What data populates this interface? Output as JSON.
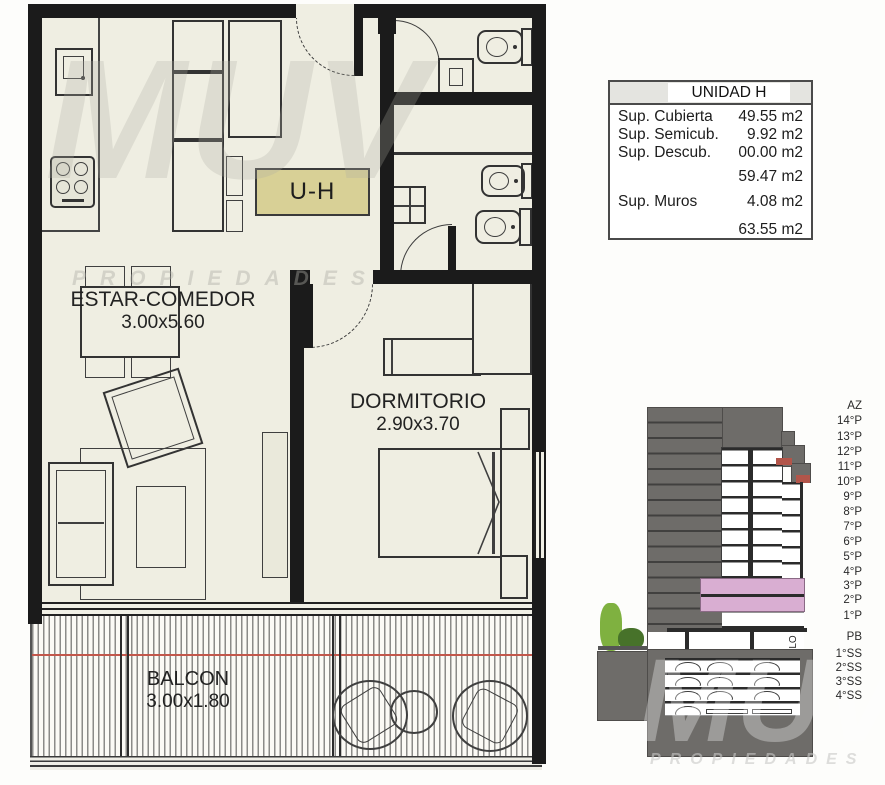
{
  "plan": {
    "unit_tag": "U-H",
    "living": {
      "name": "ESTAR-COMEDOR",
      "dims": "3.00x5.60"
    },
    "bedroom": {
      "name": "DORMITORIO",
      "dims": "2.90x3.70"
    },
    "balcony": {
      "name": "BALCON",
      "dims": "3.00x1.80"
    }
  },
  "area_table": {
    "title": "UNIDAD H",
    "rows": [
      {
        "label": "Sup. Cubierta",
        "value": "49.55 m2"
      },
      {
        "label": "Sup. Semicub.",
        "value": "9.92 m2"
      },
      {
        "label": "Sup. Descub.",
        "value": "00.00 m2"
      },
      {
        "label": "",
        "value": "59.47 m2"
      },
      {
        "label": "Sup. Muros",
        "value": "4.08 m2"
      },
      {
        "label": "",
        "value": "63.55 m2"
      }
    ]
  },
  "elevation": {
    "floor_labels": [
      "AZ",
      "14°P",
      "13°P",
      "12°P",
      "11°P",
      "10°P",
      "9°P",
      "8°P",
      "7°P",
      "6°P",
      "5°P",
      "4°P",
      "3°P",
      "2°P",
      "1°P",
      "PB",
      "1°SS",
      "2°SS",
      "3°SS",
      "4°SS"
    ],
    "highlighted_floors": [
      "3°P",
      "2°P"
    ],
    "side_label": "LO"
  },
  "watermark": {
    "brand": "MUV",
    "subtitle": "PROPIEDADES"
  },
  "colors": {
    "wall": "#1b1b1b",
    "floor": "#efeee2",
    "unit_tag_bg": "#d8d096",
    "building_gray": "#6e6c69",
    "highlight_pink": "#d9aed2",
    "accent_red": "#c2574b",
    "tree_green_light": "#7fb140",
    "tree_green_dark": "#47722a"
  }
}
